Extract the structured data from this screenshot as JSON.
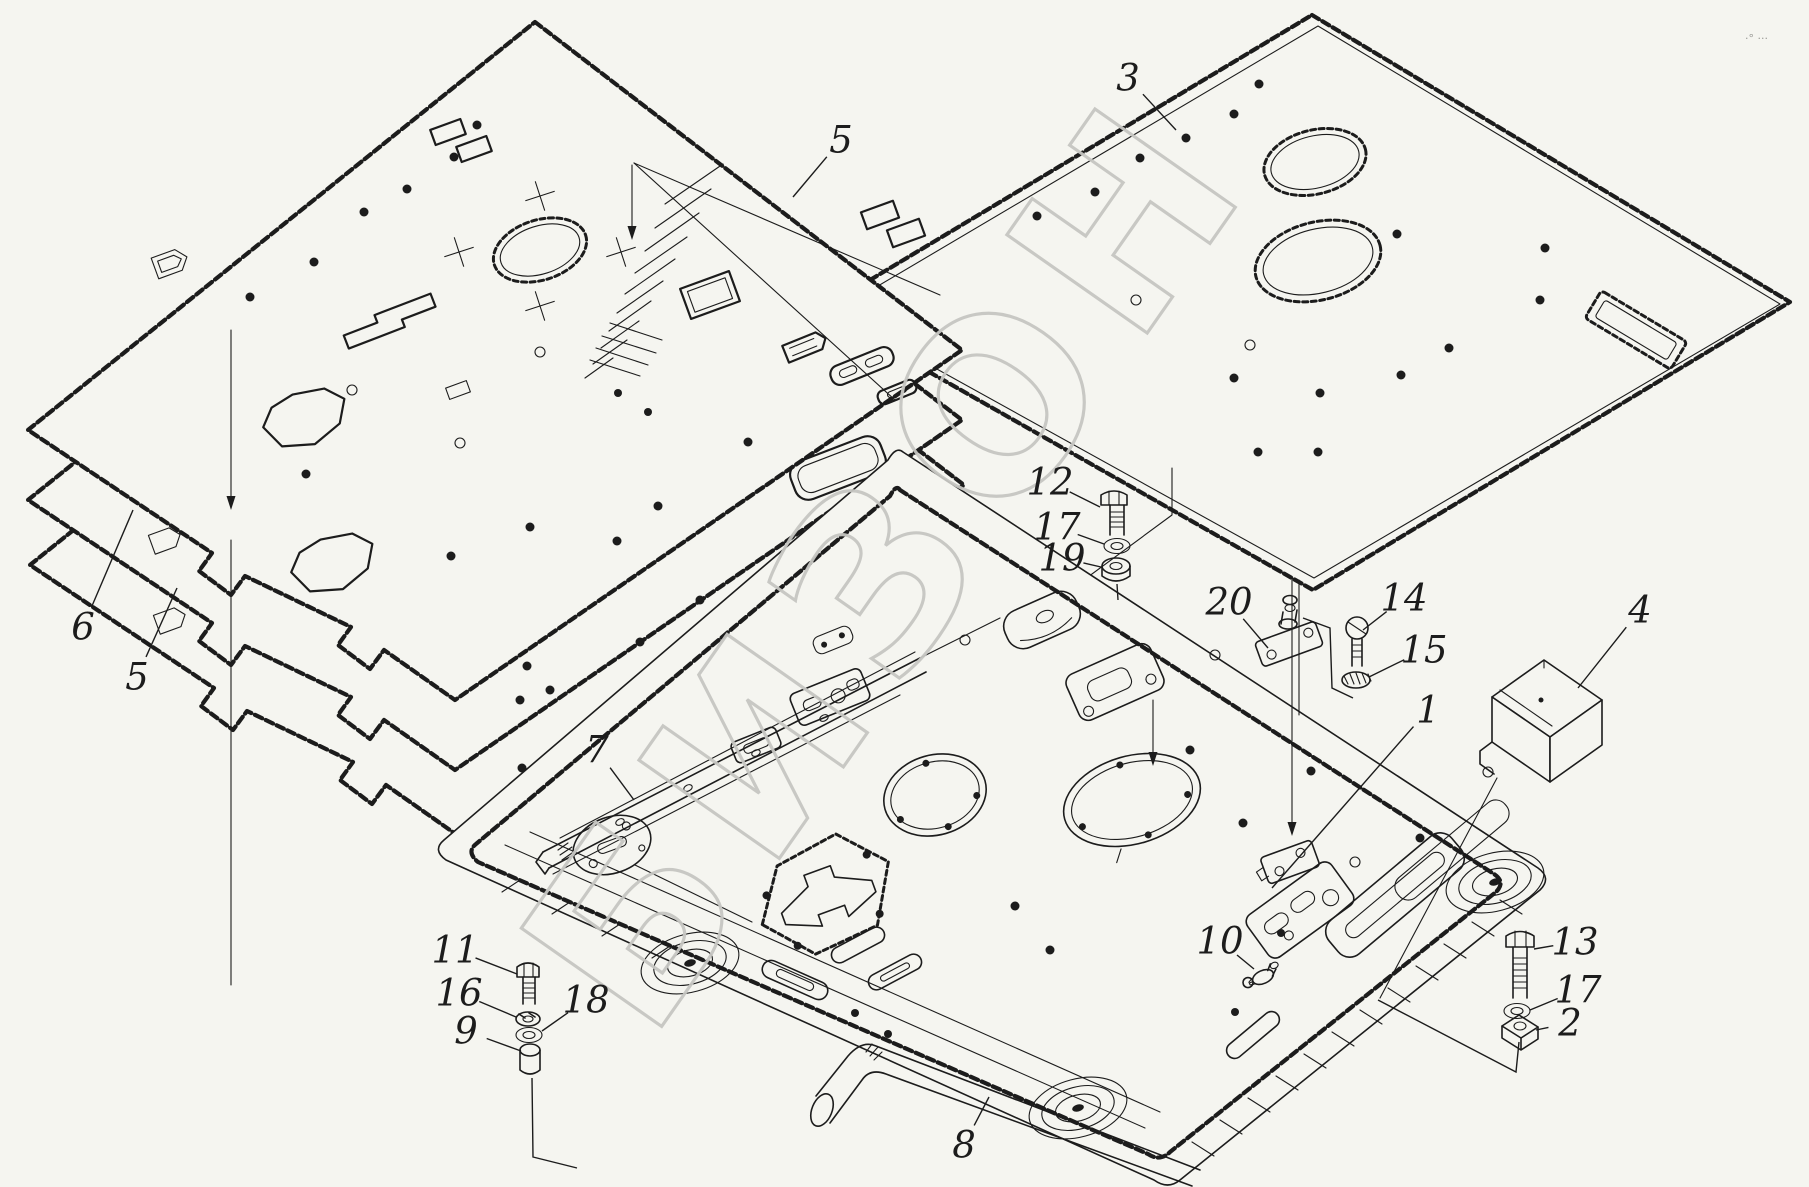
{
  "watermark": {
    "text": "БИЗОН"
  },
  "corner_mark": "·° ···",
  "colors": {
    "ink": "#1c1c1c",
    "background": "#f5f5f0",
    "watermark": "#c6c6c2"
  },
  "callouts": [
    {
      "label": "3",
      "x": 1128,
      "y": 78,
      "tx": 1176,
      "ty": 130
    },
    {
      "label": "5",
      "x": 841,
      "y": 140,
      "tx": 793,
      "ty": 197
    },
    {
      "label": "6",
      "x": 83,
      "y": 627,
      "tx": 133,
      "ty": 510
    },
    {
      "label": "5",
      "x": 137,
      "y": 677,
      "tx": 177,
      "ty": 588
    },
    {
      "label": "7",
      "x": 597,
      "y": 750,
      "tx": 634,
      "ty": 800
    },
    {
      "label": "12",
      "x": 1050,
      "y": 482,
      "tx": 1100,
      "ty": 507
    },
    {
      "label": "17",
      "x": 1057,
      "y": 527,
      "tx": 1104,
      "ty": 544
    },
    {
      "label": "19",
      "x": 1062,
      "y": 558,
      "tx": 1101,
      "ty": 567
    },
    {
      "label": "20",
      "x": 1229,
      "y": 602,
      "tx": 1268,
      "ty": 648
    },
    {
      "label": "14",
      "x": 1404,
      "y": 598,
      "tx": 1363,
      "ty": 630
    },
    {
      "label": "15",
      "x": 1424,
      "y": 650,
      "tx": 1369,
      "ty": 677
    },
    {
      "label": "4",
      "x": 1640,
      "y": 610,
      "tx": 1578,
      "ty": 688
    },
    {
      "label": "1",
      "x": 1428,
      "y": 710,
      "tx": 1272,
      "ty": 888
    },
    {
      "label": "10",
      "x": 1220,
      "y": 941,
      "tx": 1254,
      "ty": 969
    },
    {
      "label": "13",
      "x": 1575,
      "y": 942,
      "tx": 1534,
      "ty": 949
    },
    {
      "label": "17",
      "x": 1578,
      "y": 990,
      "tx": 1530,
      "ty": 1010
    },
    {
      "label": "2",
      "x": 1570,
      "y": 1023,
      "tx": 1536,
      "ty": 1030
    },
    {
      "label": "11",
      "x": 455,
      "y": 950,
      "tx": 517,
      "ty": 974
    },
    {
      "label": "16",
      "x": 459,
      "y": 993,
      "tx": 516,
      "ty": 1017
    },
    {
      "label": "9",
      "x": 466,
      "y": 1031,
      "tx": 521,
      "ty": 1051
    },
    {
      "label": "18",
      "x": 586,
      "y": 1000,
      "tx": 542,
      "ty": 1031
    },
    {
      "label": "8",
      "x": 964,
      "y": 1145,
      "tx": 989,
      "ty": 1097
    }
  ]
}
